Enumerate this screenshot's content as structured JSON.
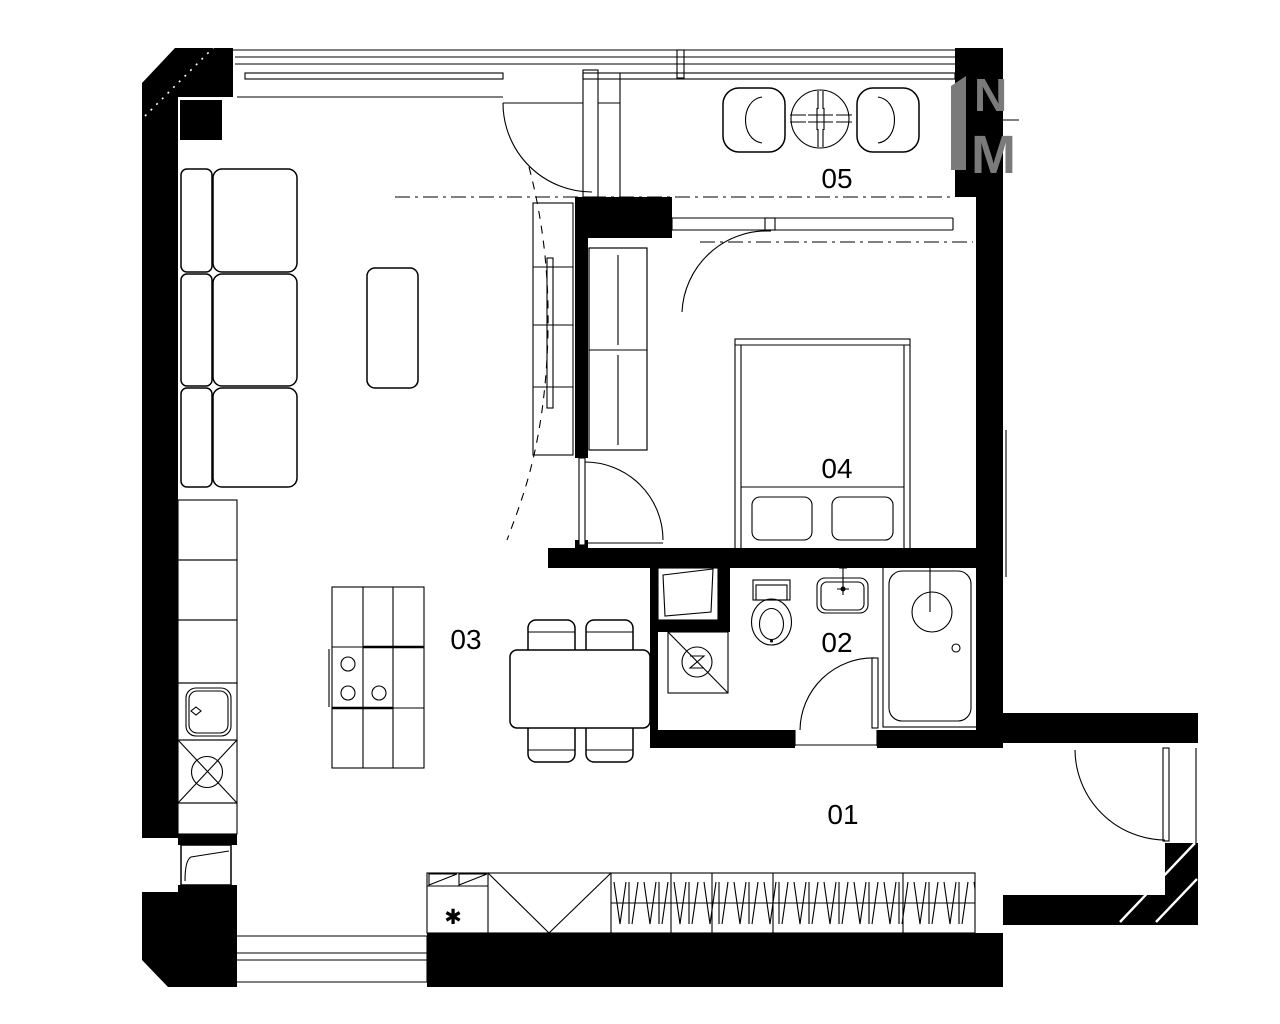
{
  "title": "apartment-floor-plan",
  "room_labels": [
    "01",
    "02",
    "03",
    "04",
    "05"
  ],
  "wardrobe_marker": "✱",
  "watermark": {
    "line1": "N",
    "line2": "M",
    "color": "#7a7a7a"
  },
  "colors": {
    "ink": "#000000",
    "background": "#ffffff",
    "watermark_gray": "#7a7a7a"
  }
}
